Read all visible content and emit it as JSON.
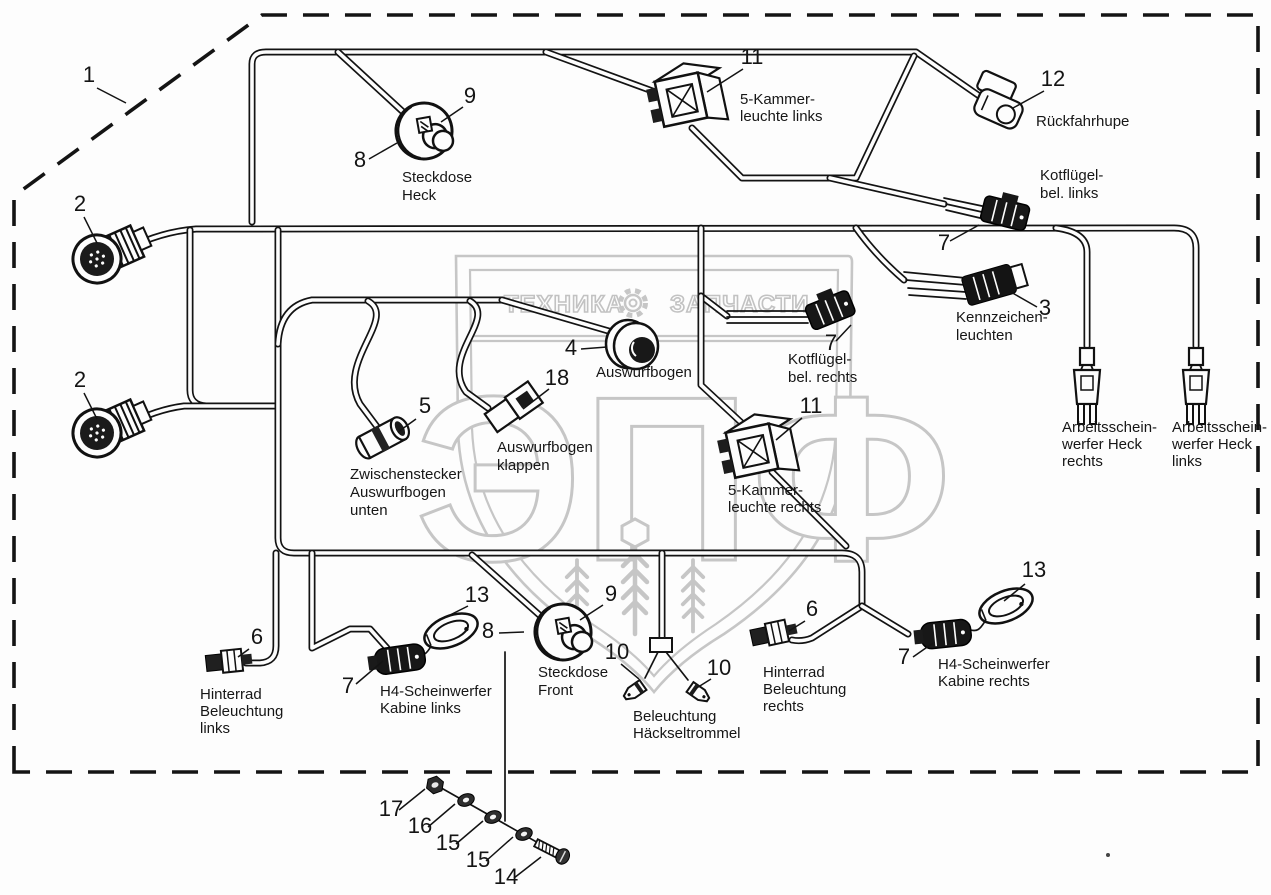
{
  "watermark": {
    "band_left": "ТЕХНИКА",
    "band_right": "ЗАПЧАСТИ",
    "monogram": "ЭПФ",
    "color": "#c6c6c6"
  },
  "callouts": {
    "c1": "1",
    "c2a": "2",
    "c2b": "2",
    "c3": "3",
    "c4": "4",
    "c5": "5",
    "c6l": "6",
    "c6r": "6",
    "c7t": "7",
    "c7m": "7",
    "c7bl": "7",
    "c7br": "7",
    "c8t": "8",
    "c8f": "8",
    "c9t": "9",
    "c9f": "9",
    "c10a": "10",
    "c10b": "10",
    "c11t": "11",
    "c11b": "11",
    "c12": "12",
    "c13l": "13",
    "c13r": "13",
    "c14": "14",
    "c15a": "15",
    "c15b": "15",
    "c16": "16",
    "c17": "17",
    "c18": "18"
  },
  "labels": {
    "steckdose_heck": [
      "Steckdose",
      "Heck"
    ],
    "kammer_links": [
      "5-Kammer-",
      "leuchte links"
    ],
    "rueckfahrhupe": [
      "Rückfahrhupe"
    ],
    "kotfluegel_links": [
      "Kotflügel-",
      "bel. links"
    ],
    "kennzeichen_leuchten": [
      "Kennzeichen-",
      "leuchten"
    ],
    "kotfluegel_rechts": [
      "Kotflügel-",
      "bel. rechts"
    ],
    "auswurfbogen": [
      "Auswurfbogen"
    ],
    "auswurfbogen_klappen": [
      "Auswurfbogen",
      "klappen"
    ],
    "zwischenstecker": [
      "Zwischenstecker",
      "Auswurfbogen",
      "unten"
    ],
    "kammer_rechts": [
      "5-Kammer-",
      "leuchte rechts"
    ],
    "arbeitsscheinwerfer_rechts": [
      "Arbeitsschein-",
      "werfer Heck",
      "rechts"
    ],
    "arbeitsscheinwerfer_links": [
      "Arbeitsschein-",
      "werfer Heck",
      "links"
    ],
    "hinterrad_links": [
      "Hinterrad",
      "Beleuchtung",
      "links"
    ],
    "h4_links": [
      "H4-Scheinwerfer",
      "Kabine links"
    ],
    "steckdose_front": [
      "Steckdose",
      "Front"
    ],
    "beleuchtung_haeckseltrommel": [
      "Beleuchtung",
      "Häckseltrommel"
    ],
    "hinterrad_rechts": [
      "Hinterrad",
      "Beleuchtung",
      "rechts"
    ],
    "h4_rechts": [
      "H4-Scheinwerfer",
      "Kabine rechts"
    ]
  }
}
